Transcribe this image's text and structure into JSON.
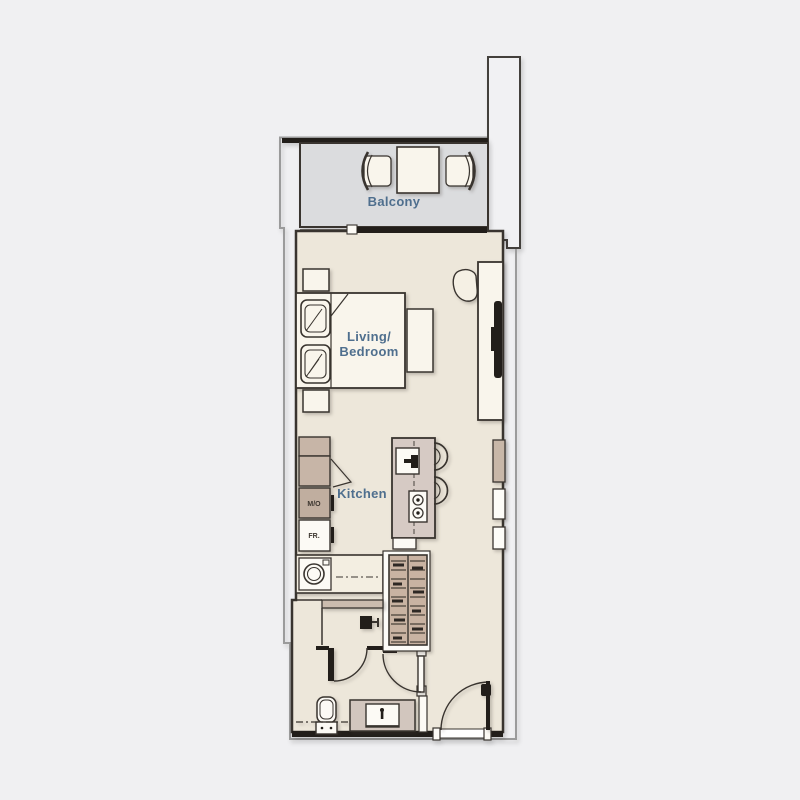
{
  "plan": {
    "type": "studio-apartment-floor-plan",
    "rooms": [
      "Balcony",
      "Living/Bedroom",
      "Kitchen",
      "Bathroom",
      "Entry"
    ],
    "fixtures": [
      "balcony-table",
      "balcony-chair-left",
      "balcony-chair-right",
      "sliding-door",
      "bed",
      "pillows",
      "nightstand-top",
      "nightstand-bottom",
      "bench",
      "tv-unit",
      "tv-screen",
      "lounge-chair",
      "kitchen-cabinets",
      "microwave-oven-unit",
      "fridge-unit",
      "washing-machine",
      "kitchen-island",
      "island-sink",
      "cooktop",
      "bar-stool-1",
      "bar-stool-2",
      "wardrobe-closet",
      "shower",
      "shower-head",
      "toilet",
      "vanity-sink",
      "bathroom-door",
      "shower-door",
      "entry-door"
    ]
  },
  "labels": {
    "balcony": "Balcony",
    "living1": "Living/",
    "living2": "Bedroom",
    "kitchen": "Kitchen",
    "mo": "M/O",
    "fr": "FR."
  },
  "colors": {
    "background": "#F0F0F2",
    "floor": "#EDE7DA",
    "balcony_floor": "#DBDCDE",
    "wall_dark": "#39342F",
    "outer_outline": "#9B9B9B",
    "furniture_fill": "#F9F5EC",
    "counter_tan": "#C7B5A7",
    "island_fill": "#D6CAC4",
    "closet_fill": "#C9B3A2",
    "label_text": "#4F6F8E",
    "tv_black": "#221E1A"
  }
}
